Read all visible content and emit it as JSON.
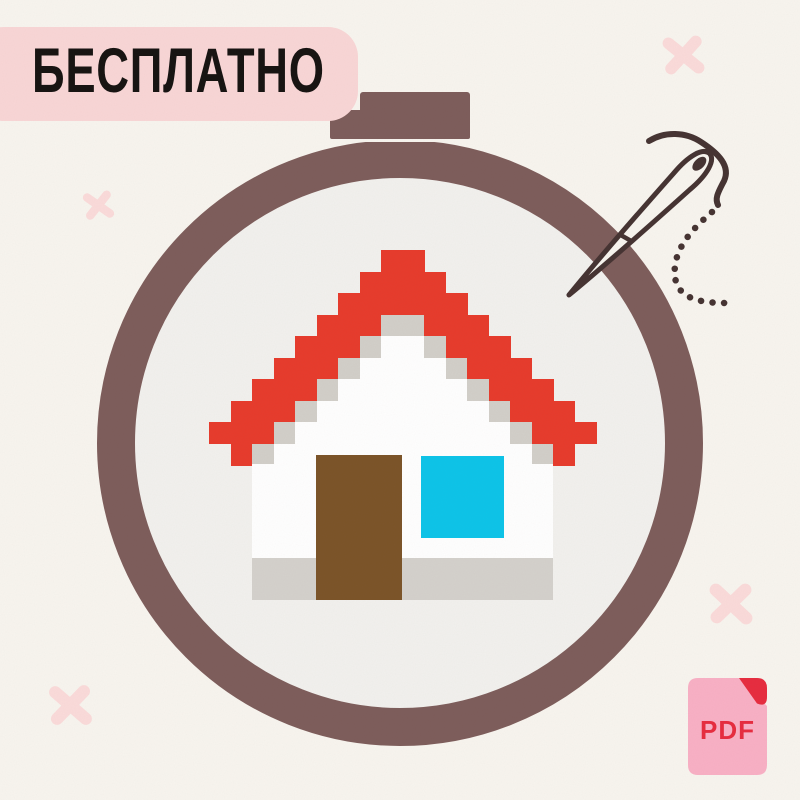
{
  "background_color": "#f8f5ef",
  "title_badge": {
    "label": "БЕСПЛАТНО",
    "bg_color": "#f9d6d6",
    "text_color": "#151210"
  },
  "hoop": {
    "ring_color": "#7d5c5a",
    "fabric_color": "#f2f1ee",
    "screw_color": "#7d5c5a"
  },
  "needle": {
    "color": "#443231",
    "thread_trail": "dotted"
  },
  "cross_stitch_pattern": {
    "subject": "pixel-house",
    "cell_size": 21.5,
    "palette": {
      "R": "#e73a2b",
      "G": "#d2cfc9",
      "W": "#ffffff"
    },
    "grid": [
      "........RR........",
      ".......RRRR.......",
      "......RRRRRR......",
      ".....RRRGGRRR.....",
      "....RRRGWWGRRR....",
      "...RRRGWWWWGRRR...",
      "..RRRGWWWWWWGRRR..",
      ".RRRGWWWWWWWWGRRR.",
      "RRRGWWWWWWWWWWGRRR",
      ".RGWWWWWWWWWWWWGR."
    ],
    "body_color": "#ffffff",
    "floor_color": "#d4d1cc",
    "window_color": "#0bc4e9",
    "door_color": "#7b5327"
  },
  "stitch_marks": {
    "color": "#fbdbda",
    "positions": [
      {
        "x": 662,
        "y": 34,
        "size": 43,
        "rot": -6
      },
      {
        "x": 83,
        "y": 190,
        "size": 31,
        "rot": -10
      },
      {
        "x": 48,
        "y": 683,
        "size": 45,
        "rot": -4
      },
      {
        "x": 708,
        "y": 581,
        "size": 46,
        "rot": -2
      }
    ]
  },
  "pdf_badge": {
    "label": "PDF",
    "body_color": "#f9b0c5",
    "accent_color": "#e72b3e"
  }
}
